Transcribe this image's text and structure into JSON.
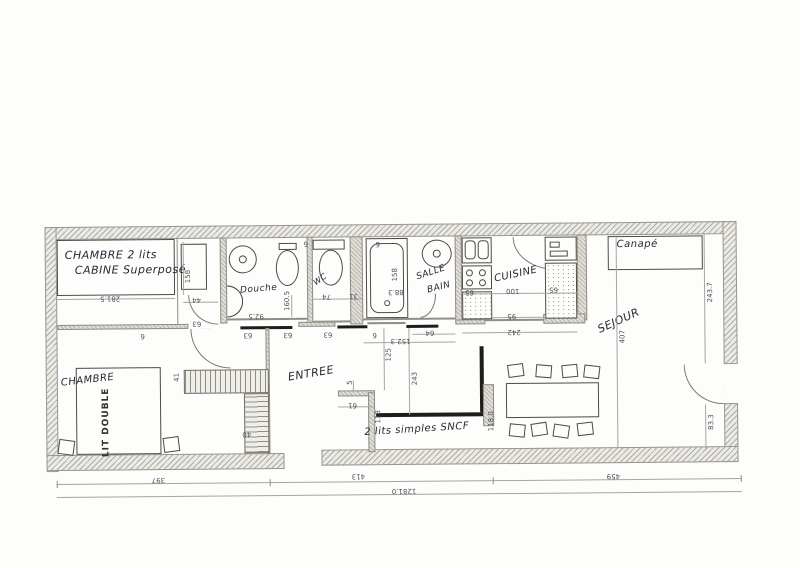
{
  "rooms": {
    "cabine_line1": "CHAMBRE 2 lits",
    "cabine_line2": "CABINE Superposé",
    "douche": "Douche",
    "wc": "WC",
    "salle_bain_line1": "SALLE",
    "salle_bain_line2": "BAIN",
    "cuisine": "CUISINE",
    "sejour": "SEJOUR",
    "canape": "Canapé",
    "chambre": "CHAMBRE",
    "lit_double": "LIT DOUBLE",
    "entree": "ENTREE",
    "sncf": "2 lits simples SNCF"
  },
  "dims": {
    "d281_5": "281.5",
    "d158_a": "158",
    "d44": "44",
    "d160_5": "160.5",
    "d92_5": "92.5",
    "d63_a": "63",
    "d63_b": "63",
    "d63_c": "63",
    "d63_d": "63",
    "d6_a": "6",
    "d6_b": "6",
    "d9_a": "9",
    "d9_b": "9",
    "d74": "74",
    "d31": "31",
    "d158_b": "158",
    "d88_3": "88.3",
    "d64": "64",
    "d152_3": "152.3",
    "d65_a": "65",
    "d100": "100",
    "d65_b": "65",
    "d95": "95",
    "d242": "242",
    "d125": "125",
    "d243": "243",
    "d5": "5",
    "d61": "61",
    "d118": "118",
    "d118_0": "118.0",
    "d407": "407",
    "d243_7": "243.7",
    "d83_3": "83.3",
    "d41": "41",
    "d40": "40",
    "d397": "397",
    "d413": "413",
    "d459": "459",
    "d1281_0": "1281.0"
  }
}
